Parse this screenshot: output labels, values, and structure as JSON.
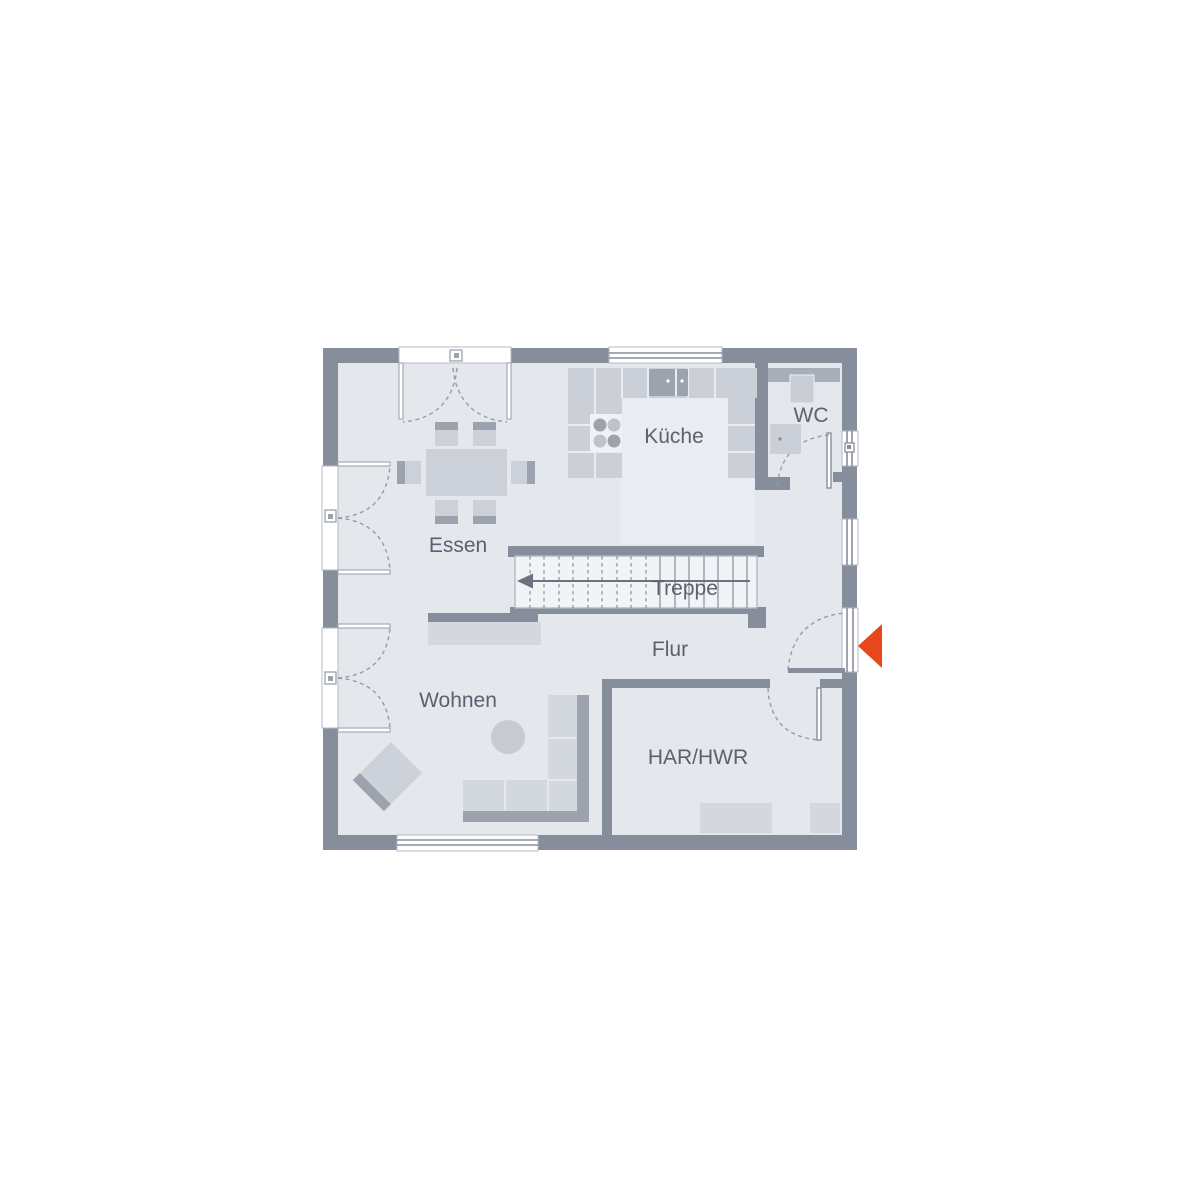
{
  "page": {
    "type": "floor-plan",
    "background": "#ffffff"
  },
  "labels": {
    "essen": "Essen",
    "kueche": "Küche",
    "wc": "WC",
    "treppe": "Treppe",
    "flur": "Flur",
    "wohnen": "Wohnen",
    "har_hwr": "HAR/HWR"
  },
  "colors": {
    "wall": "#878E9B",
    "floor": "#E4E7EC",
    "kitchen_floor_patch": "#E9ECF0",
    "furniture_light": "#D3D7DE",
    "counter": "#CBD0D8",
    "furniture_dark": "#9CA2AE",
    "stair_body": "#F2F3F6",
    "arc_dash": "#959CA8",
    "text": "#5A6170",
    "entrance_arrow": "#E7481B"
  },
  "icons": {
    "entrance_arrow": "entrance-direction-arrow",
    "stair_direction_arrow": "stair-up-arrow"
  }
}
